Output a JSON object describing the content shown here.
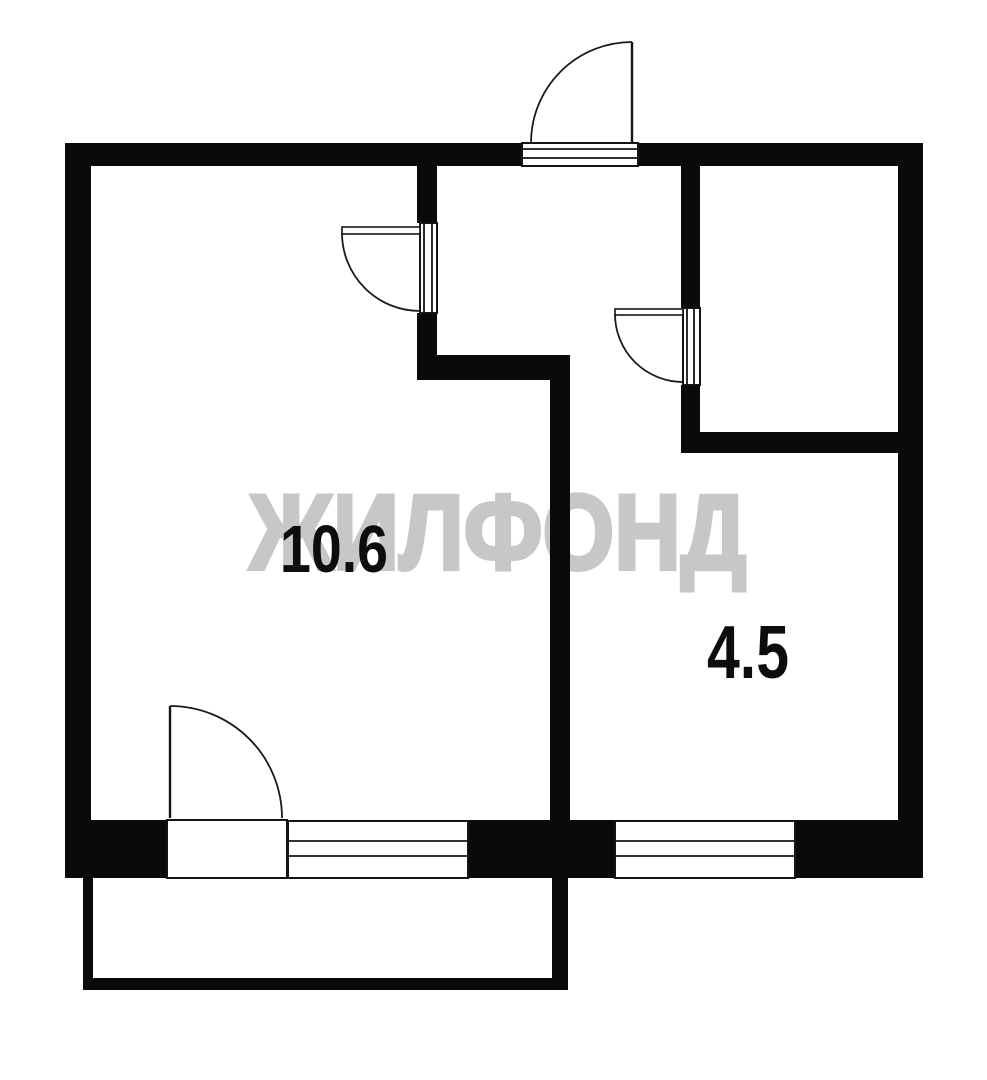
{
  "page": {
    "title": "Apartment floor plan",
    "background": "#ffffff"
  },
  "watermark": {
    "text": "ЖИЛФОНД",
    "color": "#c7c7c7"
  },
  "rooms": {
    "left": {
      "area_label": "10.6"
    },
    "right": {
      "area_label": "4.5"
    }
  },
  "colors": {
    "wall": "#0a0a0a",
    "thin_line": "#141414",
    "label_text": "#0d0d0d",
    "background": "#ffffff"
  },
  "symbols": {
    "door_count": "4",
    "window_count": "2"
  }
}
